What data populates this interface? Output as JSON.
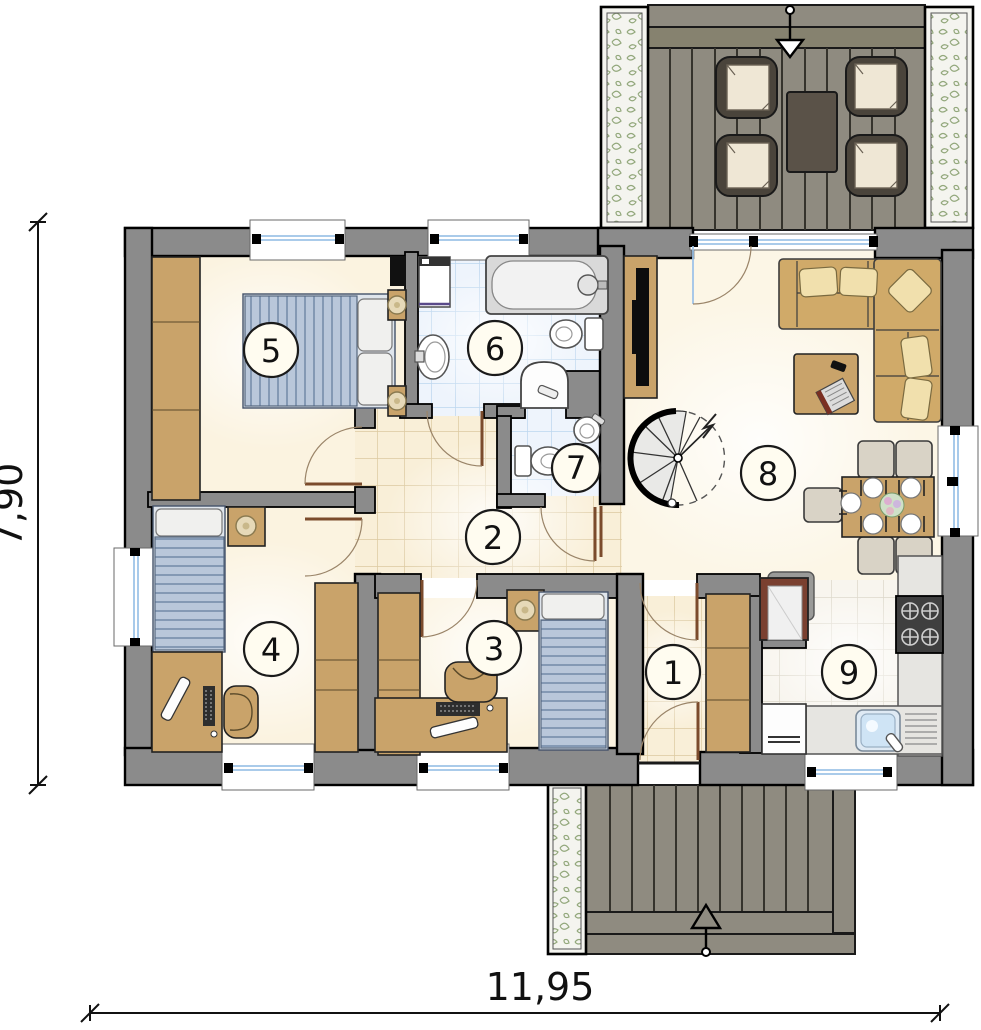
{
  "drawing": {
    "type": "house floor plan",
    "rooms": {
      "r1": "1",
      "r2": "2",
      "r3": "3",
      "r4": "4",
      "r5": "5",
      "r6": "6",
      "r7": "7",
      "r8": "8",
      "r9": "9"
    },
    "dimensions": {
      "vertical": "7,90",
      "horizontal": "11,95"
    },
    "colors": {
      "wall": "#8b8b8b",
      "wall_outline": "#000000",
      "floor_cream": "#fbf3e0",
      "hall_tile": "#f9efd8",
      "bath_tile": "#eef4fc",
      "kitchen_tile": "#f8f5ee",
      "furniture_wood": "#c9a36a",
      "bed_fabric": "#b9c7da",
      "sofa": "#d0aa69",
      "pillow_cream": "#f1e0ad",
      "deck_wood": "#8f8b80",
      "planter_leaf": "#93a87c",
      "door_leaf": "#7b4b2c",
      "window_glass": "#9ec4e8",
      "kitchen_counter": "#e6e5e1",
      "fridge_frame": "#7a4030"
    }
  }
}
